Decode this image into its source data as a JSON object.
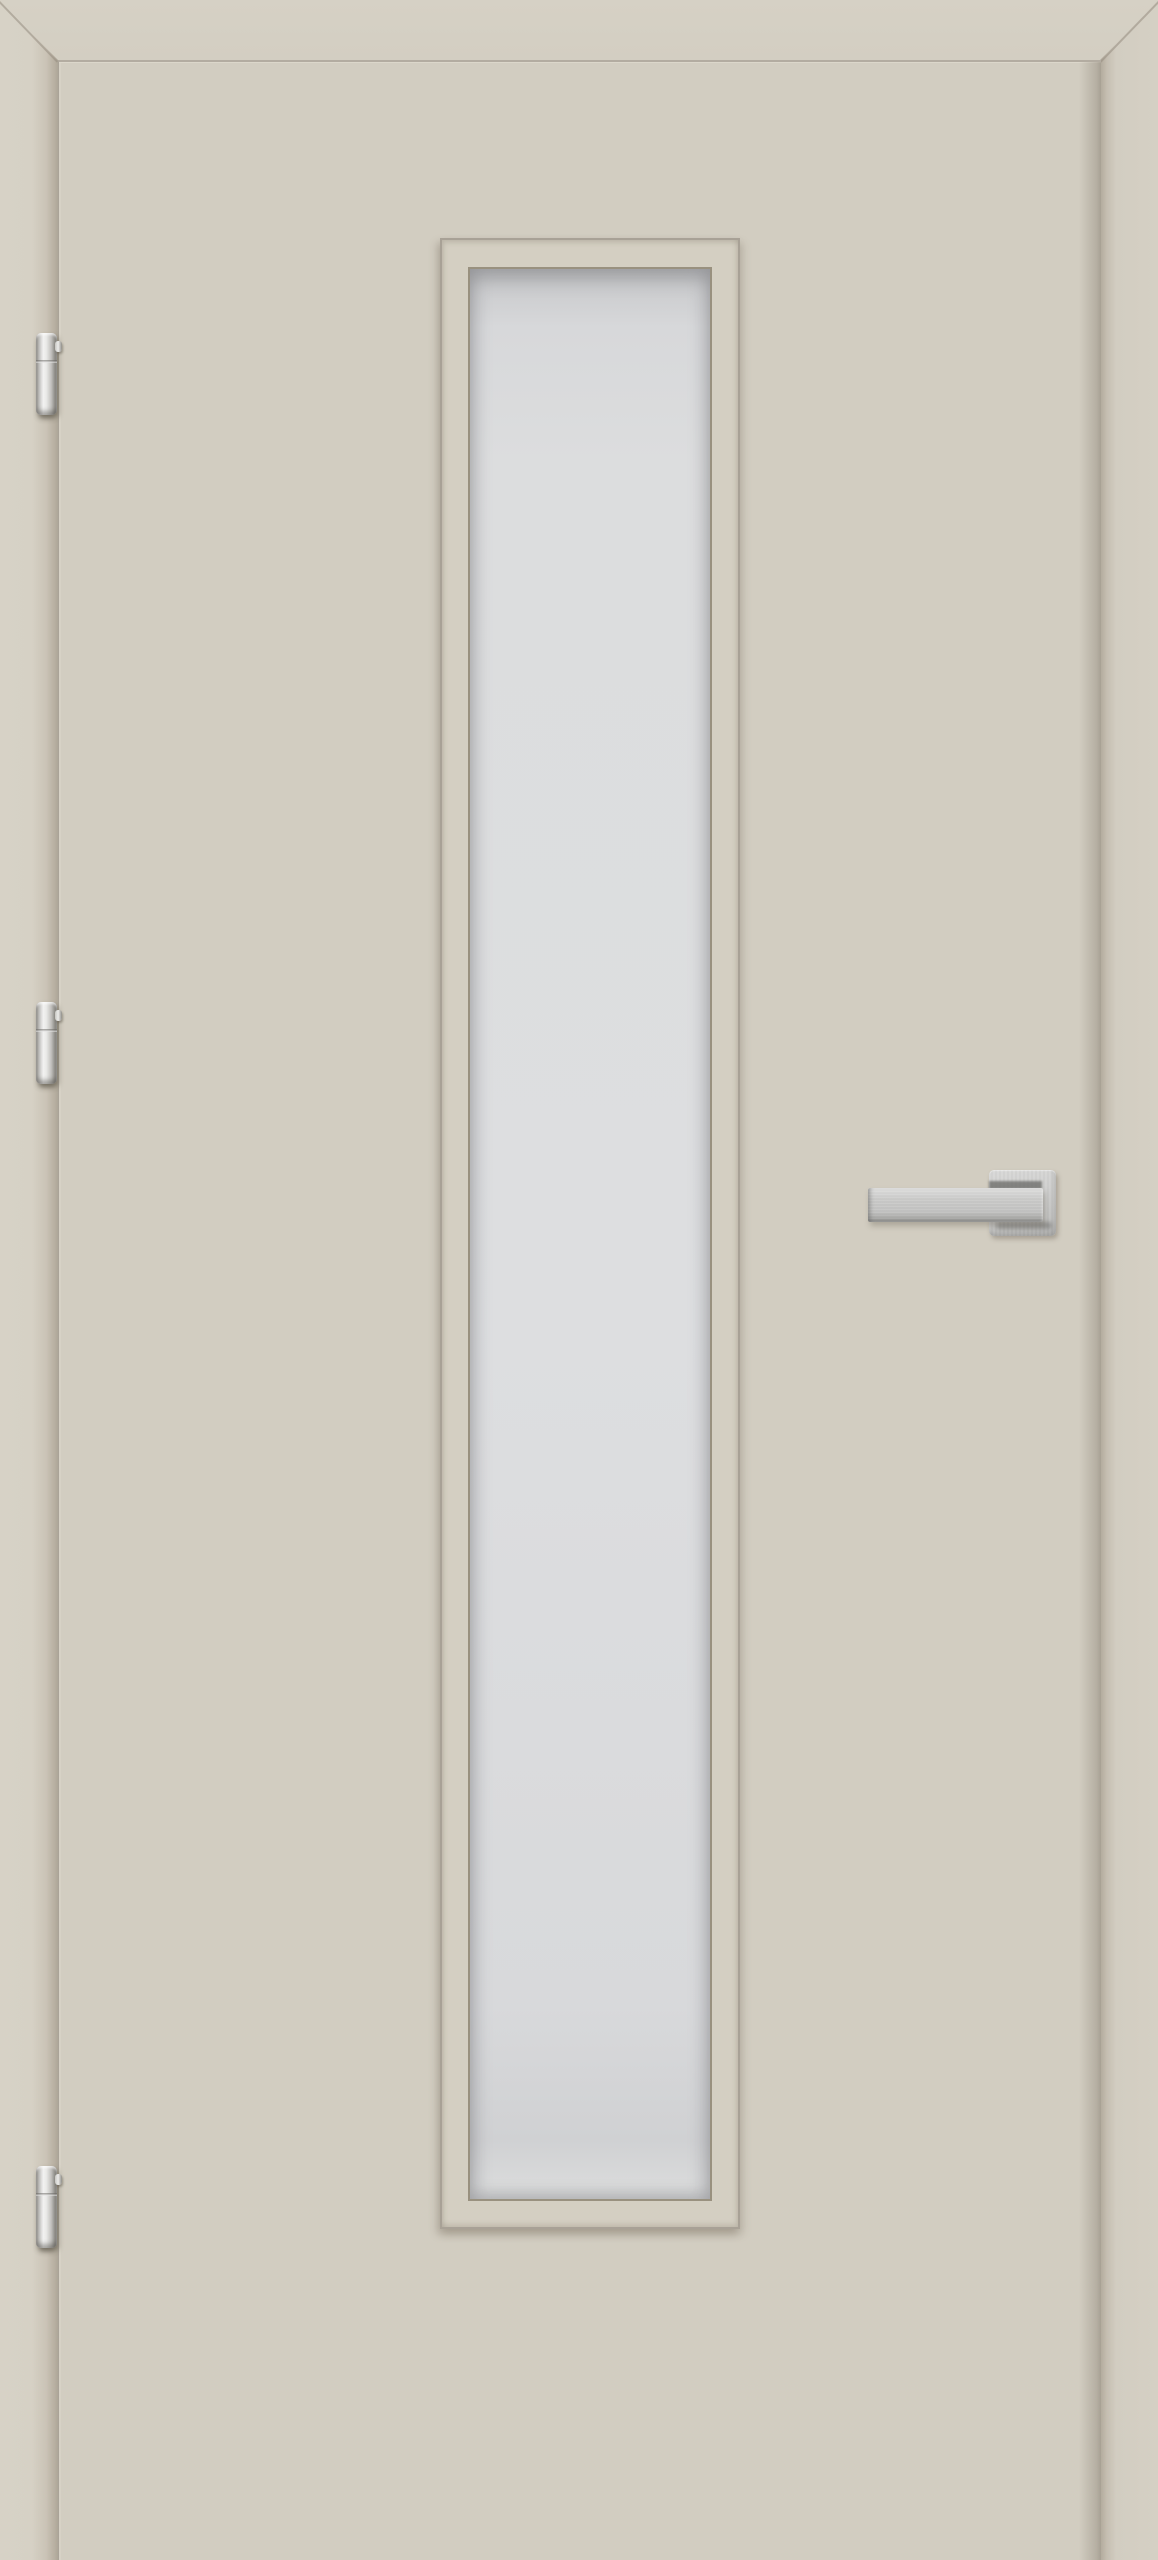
{
  "image": {
    "description": "Product photo of a cream-beige interior door in its frame: vertical frosted glass lite, three chrome barrel hinges on the left edge, square-rosette lever handle on the right",
    "door": {
      "leaf_color": "#d2cdc1",
      "frame_color": "#d6d1c5",
      "edge_line_color": "#aaa398",
      "reveal_shadow_color": "#b2aa9d",
      "glass_color": "#dddee0",
      "glass_border_color": "#99917f",
      "lite_border_color": "#a8a196",
      "hardware_finish_color": "#c8c8c7",
      "hardware_finish": "brushed chrome",
      "hinge_count": 3,
      "hinge_side": "left",
      "handle_side": "right",
      "handle_style": "square rosette with flat rectangular lever",
      "glazing": "single tall rectangular frosted lite"
    }
  }
}
